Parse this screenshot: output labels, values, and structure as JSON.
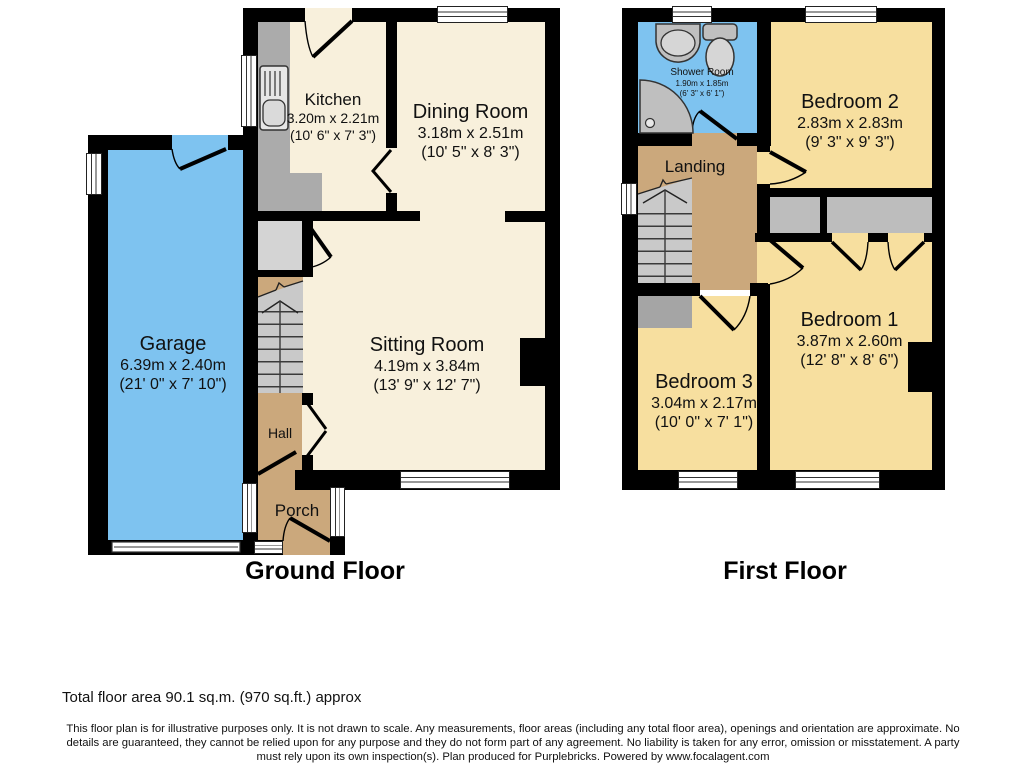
{
  "colors": {
    "room_cream": "#F8F0DC",
    "room_yellow": "#F7DF9F",
    "room_blue": "#7EC3F0",
    "room_tan": "#CBA87C",
    "fixture_gray": "#ABABAB",
    "stairs_gray": "#C9C9C9",
    "store_gray": "#D4D4D4",
    "cupboard_gray": "#BDBDBD",
    "wall": "#000000"
  },
  "ground_floor": {
    "title": "Ground Floor",
    "rooms": {
      "kitchen": {
        "name": "Kitchen",
        "metric": "3.20m x 2.21m",
        "imperial": "(10' 6\" x 7' 3\")"
      },
      "dining": {
        "name": "Dining Room",
        "metric": "3.18m x 2.51m",
        "imperial": "(10' 5\" x 8' 3\")"
      },
      "sitting": {
        "name": "Sitting Room",
        "metric": "4.19m x 3.84m",
        "imperial": "(13' 9\" x 12' 7\")"
      },
      "garage": {
        "name": "Garage",
        "metric": "6.39m x 2.40m",
        "imperial": "(21' 0\" x 7' 10\")"
      },
      "hall": {
        "name": "Hall"
      },
      "porch": {
        "name": "Porch"
      }
    }
  },
  "first_floor": {
    "title": "First Floor",
    "rooms": {
      "shower": {
        "name": "Shower Room",
        "metric": "1.90m x 1.85m",
        "imperial": "(6' 3\" x 6' 1\")"
      },
      "bedroom2": {
        "name": "Bedroom 2",
        "metric": "2.83m x 2.83m",
        "imperial": "(9' 3\" x 9' 3\")"
      },
      "bedroom1": {
        "name": "Bedroom 1",
        "metric": "3.87m x 2.60m",
        "imperial": "(12' 8\" x 8' 6\")"
      },
      "bedroom3": {
        "name": "Bedroom 3",
        "metric": "3.04m x 2.17m",
        "imperial": "(10' 0\" x 7' 1\")"
      },
      "landing": {
        "name": "Landing"
      }
    }
  },
  "footer": {
    "total_area": "Total floor area 90.1 sq.m. (970 sq.ft.) approx",
    "disclaimer": "This floor plan is for illustrative purposes only. It is not drawn to scale. Any measurements, floor areas (including any total floor area), openings and orientation are approximate. No details are guaranteed, they cannot be relied upon for any purpose and they do not form part of any agreement. No liability is taken for any error, omission or misstatement. A party must rely upon its own inspection(s). Plan produced for Purplebricks. Powered by www.focalagent.com"
  }
}
